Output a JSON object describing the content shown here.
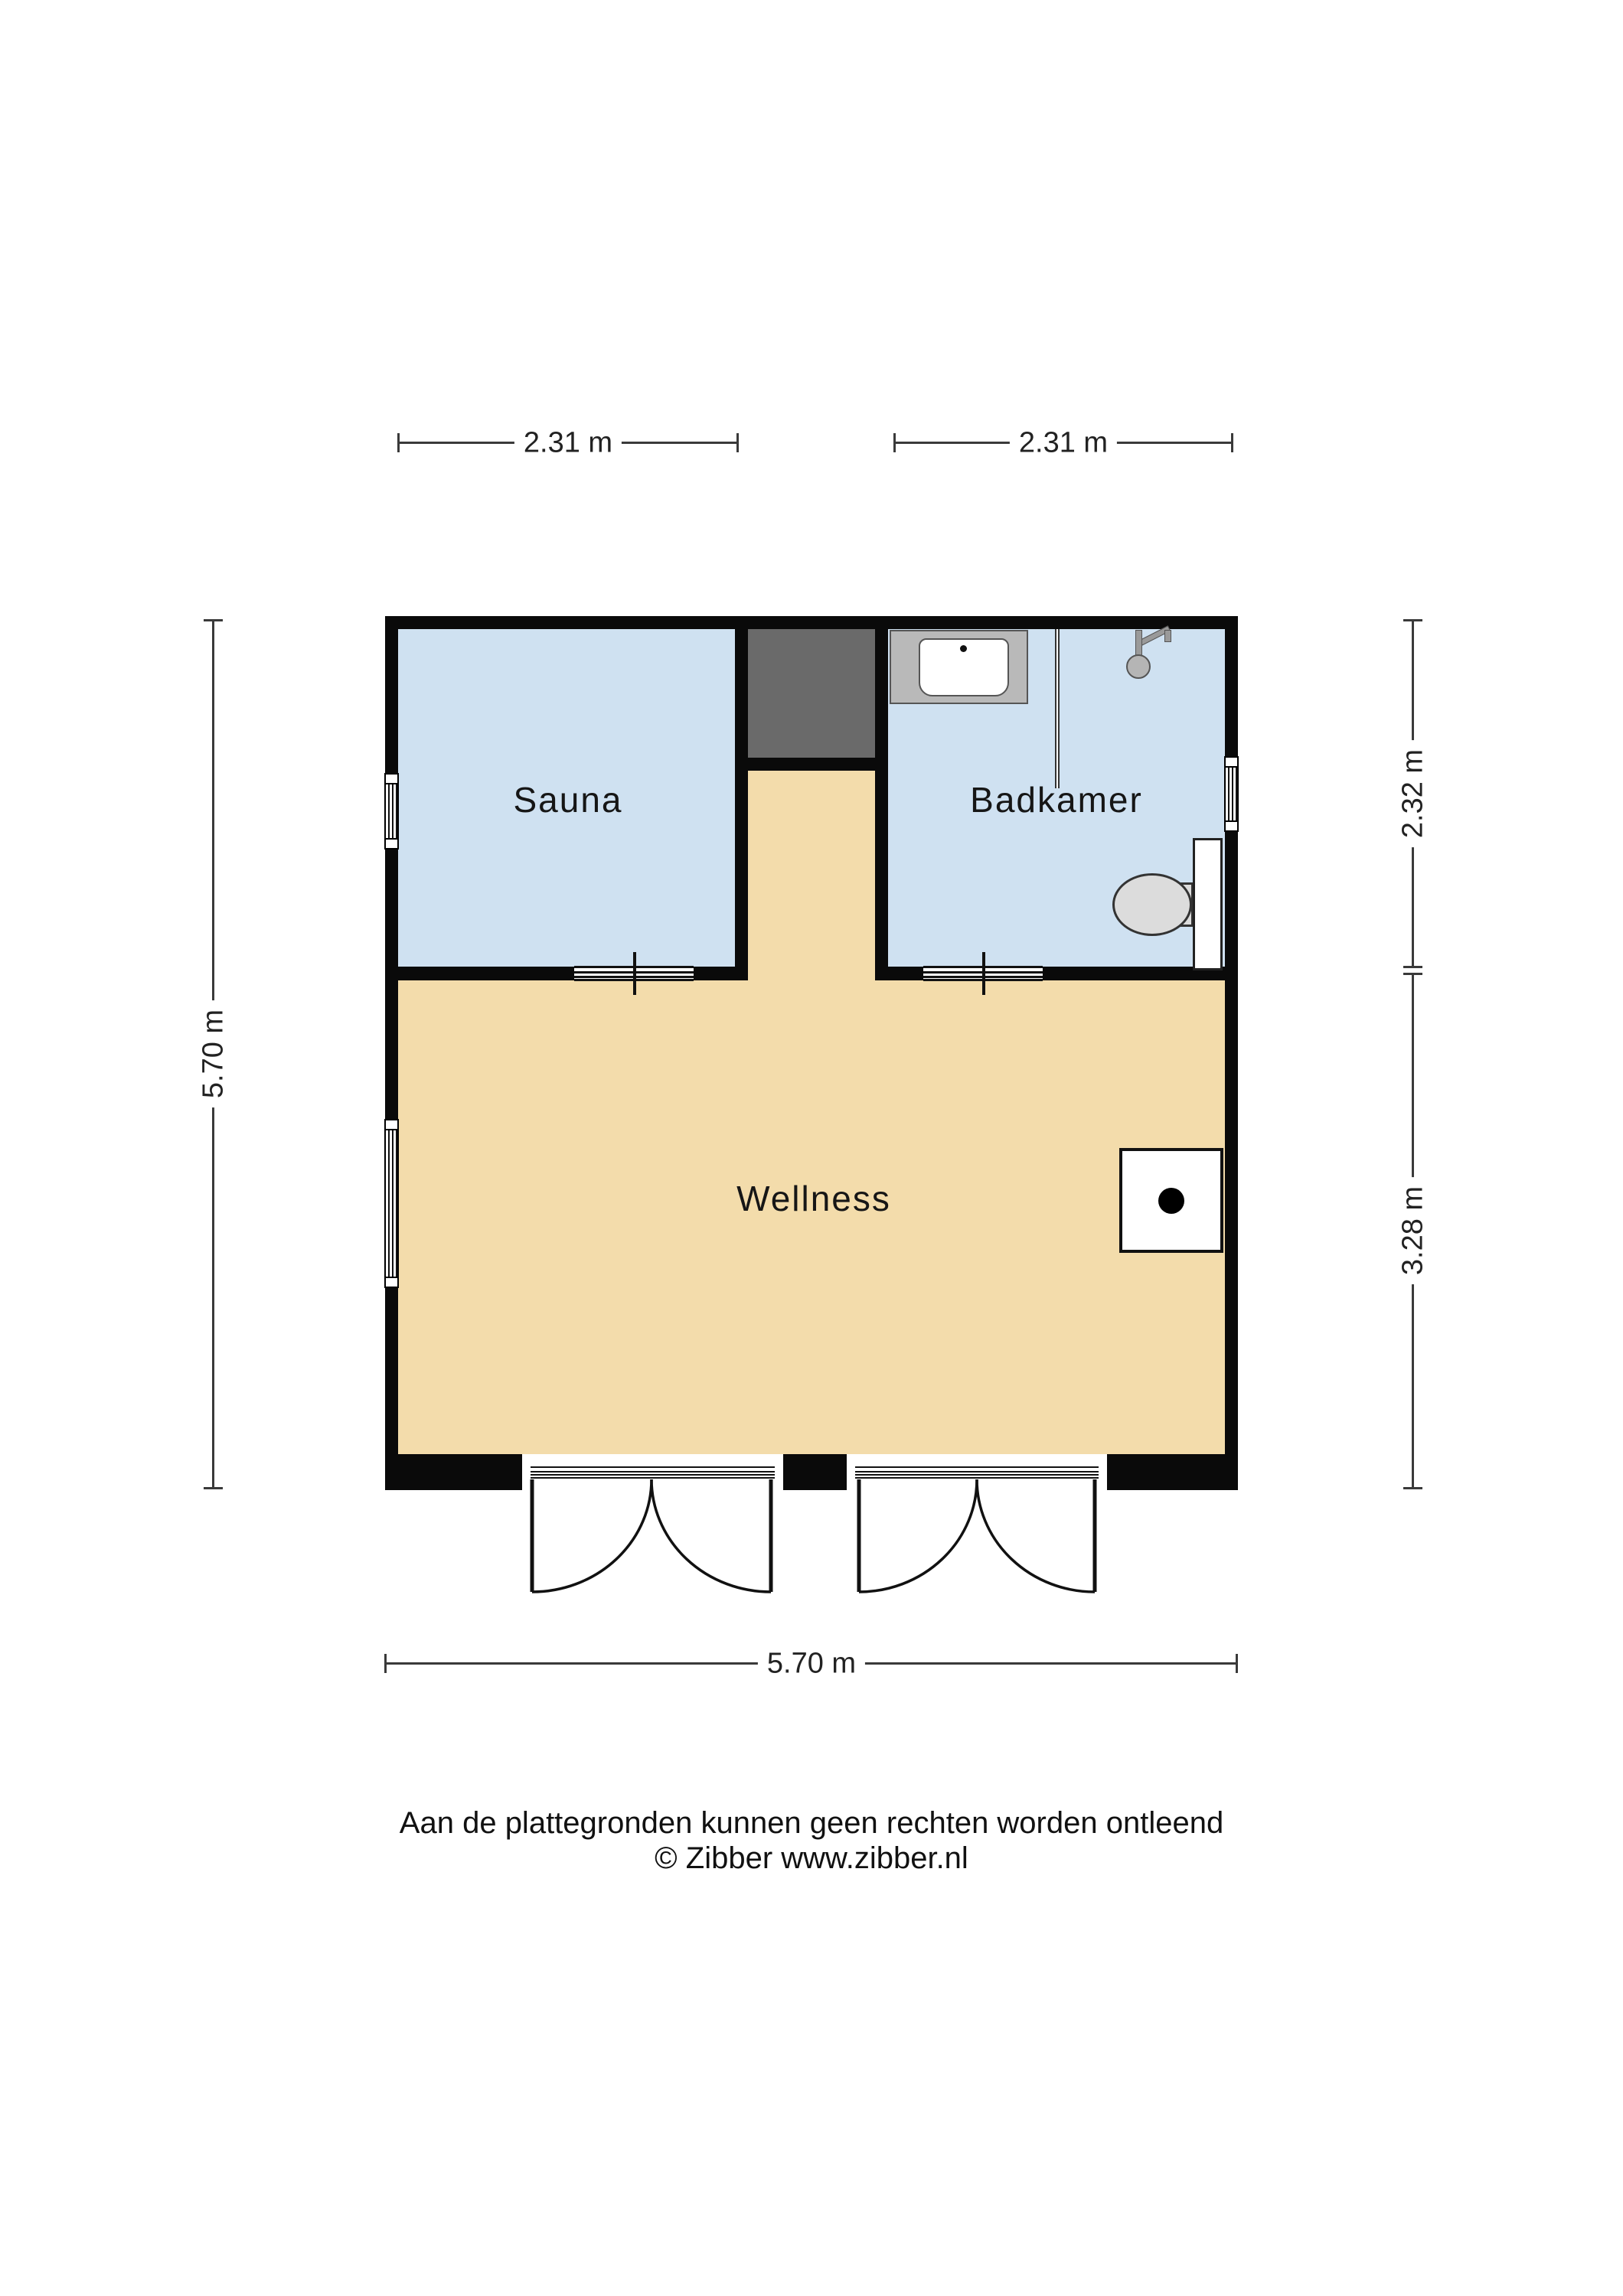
{
  "floorplan": {
    "rooms": [
      {
        "id": "sauna",
        "label": "Sauna"
      },
      {
        "id": "badkamer",
        "label": "Badkamer"
      },
      {
        "id": "wellness",
        "label": "Wellness"
      }
    ],
    "dimensions": {
      "top_left": "2.31 m",
      "top_right": "2.31 m",
      "left": "5.70 m",
      "right_top": "2.32 m",
      "right_bottom": "3.28 m",
      "bottom": "5.70 m"
    },
    "fixtures": [
      "shower-tray",
      "shower-head",
      "glass-screen",
      "toilet",
      "stove-block",
      "technical-niche",
      "window-sauna",
      "window-wellness",
      "window-badkamer",
      "sliding-door-sauna",
      "sliding-door-badkamer",
      "double-door-left",
      "double-door-right"
    ],
    "colors": {
      "wall": "#0a0a0a",
      "room_fill": "#cfe1f1",
      "floor_fill": "#f3dcab",
      "niche_fill": "#6a6a6a",
      "tray_fill": "#b9b9b9",
      "fixture_fill": "#dcdcdc",
      "dim_line": "#3a3a3a"
    }
  },
  "footer": {
    "disclaimer": "Aan de plattegronden kunnen geen rechten worden ontleend",
    "copyright": "© Zibber www.zibber.nl"
  }
}
